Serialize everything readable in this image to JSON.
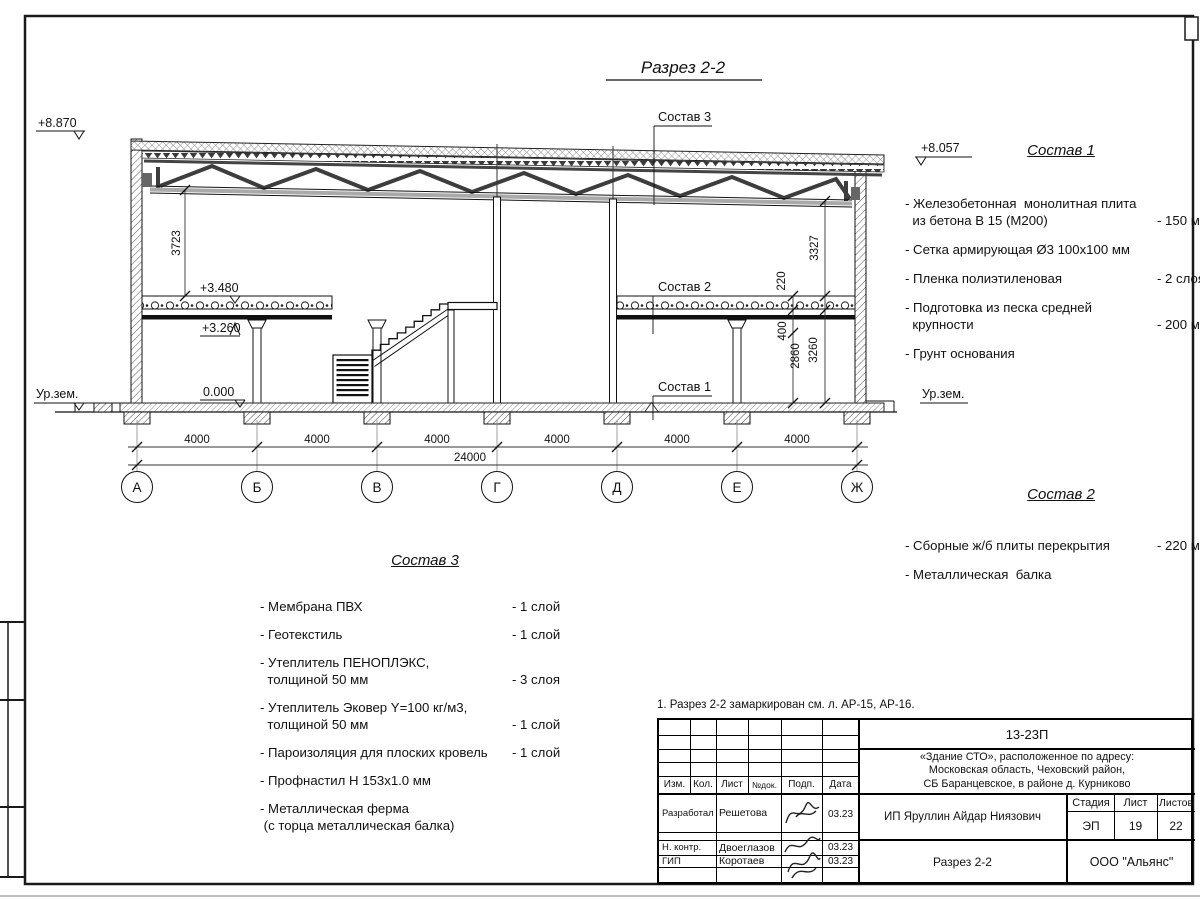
{
  "drawing": {
    "title": "Разрез 2-2",
    "levels": {
      "top_left": "+8.870",
      "top_right": "+8.057",
      "slab_top": "+3.480",
      "slab_bottom": "+3.260",
      "floor": "0.000",
      "ground_left": "Ур.зем.",
      "ground_right": "Ур.зем."
    },
    "dims": {
      "left_height": "3723",
      "right_height": "3327",
      "slab": "220",
      "beam": "400",
      "clear": "2860",
      "floor_to_slab": "3260",
      "bays": [
        "4000",
        "4000",
        "4000",
        "4000",
        "4000",
        "4000"
      ],
      "total": "24000"
    },
    "axes": [
      "А",
      "Б",
      "В",
      "Г",
      "Д",
      "Е",
      "Ж"
    ],
    "leaders": {
      "sostav1": "Состав 1",
      "sostav2": "Состав 2",
      "sostav3": "Состав 3"
    }
  },
  "sostav1": {
    "title": "Состав 1",
    "items": [
      {
        "name": "- Железобетонная  монолитная плита\n  из бетона В 15 (М200)",
        "value": "- 150 мм"
      },
      {
        "name": "- Сетка армирующая Ø3 100х100 мм"
      },
      {
        "name": "- Пленка полиэтиленовая",
        "value": "-  2 слоя"
      },
      {
        "name": "- Подготовка из песка средней\n  крупности",
        "value": "- 200 мм"
      },
      {
        "name": "- Грунт основания"
      }
    ]
  },
  "sostav2": {
    "title": "Состав 2",
    "items": [
      {
        "name": "- Сборные ж/б плиты перекрытия",
        "value": "- 220 мм"
      },
      {
        "name": "- Металлическая  балка"
      }
    ]
  },
  "sostav3": {
    "title": "Состав 3",
    "items": [
      {
        "name": "- Мембрана ПВХ",
        "value": "- 1 слой"
      },
      {
        "name": "- Геотекстиль",
        "value": "- 1 слой"
      },
      {
        "name": "- Утеплитель ПЕНОПЛЭКС,\n  толщиной 50 мм",
        "value": "- 3 слоя"
      },
      {
        "name": "- Утеплитель Эковер Y=100 кг/м3,\n  толщиной 50 мм",
        "value": "- 1 слой"
      },
      {
        "name": "- Пароизоляция для плоских кровель",
        "value": "- 1 слой"
      },
      {
        "name": "- Профнастил Н 153х1.0 мм"
      },
      {
        "name": "- Металлическая ферма\n (с торца металлическая балка)"
      }
    ]
  },
  "note": {
    "text": "1. Разрез 2-2 замаркирован см. л. АР-15, АР-16."
  },
  "stamp": {
    "doc_number": "13-23П",
    "object": "«Здание СТО», расположенное по адресу:\nМосковская область, Чеховский район,\nСБ Баранцевское, в районе д. Курниково",
    "header_cols": [
      "Изм.",
      "Кол.",
      "Лист",
      "№док.",
      "Подп.",
      "Дата"
    ],
    "rows": [
      {
        "role": "Разработал",
        "name": "Решетова",
        "date": "03.23"
      },
      {
        "role": "Н. контр.",
        "name": "Двоеглазов",
        "date": "03.23"
      },
      {
        "role": "ГИП",
        "name": "Коротаев",
        "date": "03.23"
      }
    ],
    "client": "ИП Яруллин Айдар Ниязович",
    "stage_label": "Стадия",
    "sheet_label": "Лист",
    "sheets_label": "Листов",
    "stage": "ЭП",
    "sheet": "19",
    "sheets": "22",
    "sheet_title": "Разрез 2-2",
    "company": "ООО \"Альянс\""
  }
}
